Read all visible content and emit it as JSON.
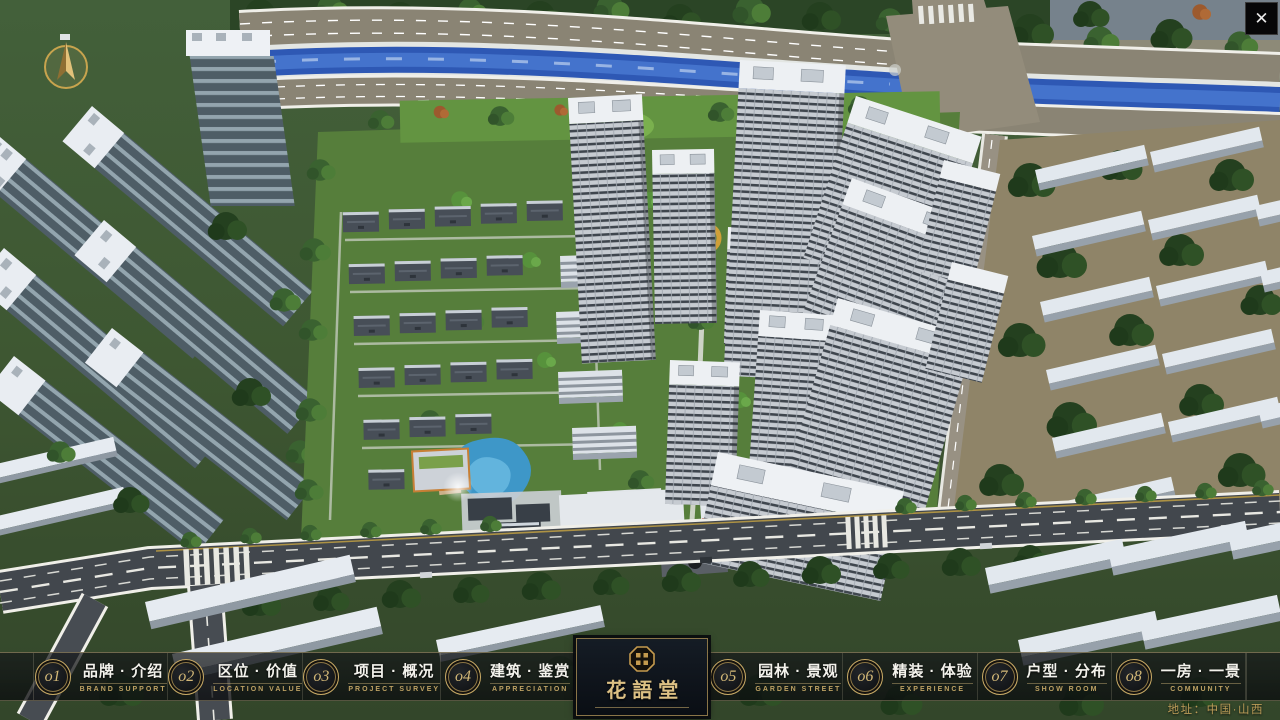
{
  "app": {
    "address": "地址：中国·山西",
    "close_label": "✕"
  },
  "logo": {
    "name": "花語堂"
  },
  "menu": {
    "items": [
      {
        "num": "o1",
        "cn": "品牌 · 介绍",
        "en": "BRAND SUPPORT"
      },
      {
        "num": "o2",
        "cn": "区位 · 价值",
        "en": "LOCATION VALUE"
      },
      {
        "num": "o3",
        "cn": "项目 · 概况",
        "en": "PROJECT SURVEY"
      },
      {
        "num": "o4",
        "cn": "建筑 · 鉴赏",
        "en": "APPRECIATION"
      },
      {
        "num": "o5",
        "cn": "园林 · 景观",
        "en": "GARDEN STREET"
      },
      {
        "num": "o6",
        "cn": "精装 · 体验",
        "en": "EXPERIENCE"
      },
      {
        "num": "o7",
        "cn": "户型 · 分布",
        "en": "SHOW ROOM"
      },
      {
        "num": "o8",
        "cn": "一房 · 一景",
        "en": "COMMUNITY"
      }
    ]
  },
  "colors": {
    "gold": "#c9ab66",
    "bar_bg": "rgba(13,15,18,0.72)",
    "river_blue": "#2e58b4"
  }
}
